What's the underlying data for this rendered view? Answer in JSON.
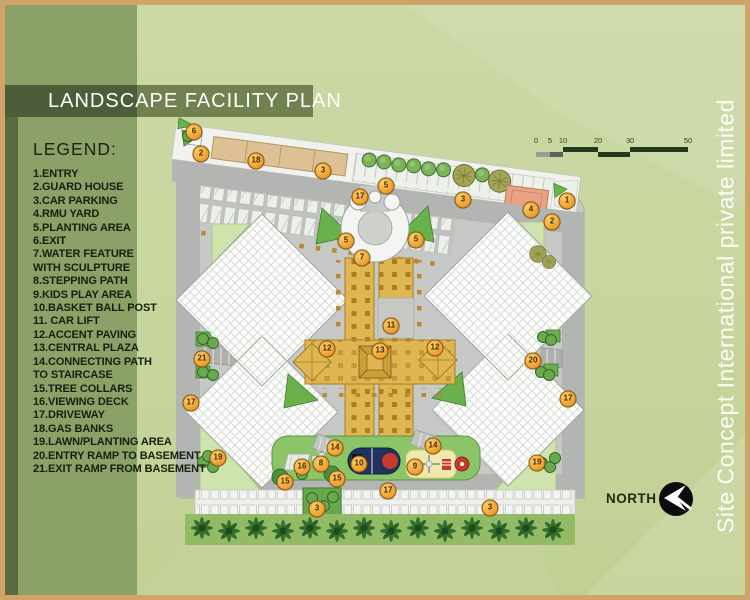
{
  "title": {
    "text": "LANDSCAPE FACILITY PLAN"
  },
  "legend": {
    "heading": "LEGEND:",
    "lines": [
      "1.ENTRY",
      "2.GUARD HOUSE",
      "3.CAR PARKING",
      "4.RMU YARD",
      "5.PLANTING AREA",
      "6.EXIT",
      "7.WATER FEATURE",
      "WITH SCULPTURE",
      "8.STEPPING PATH",
      "9.KIDS PLAY AREA",
      "10.BASKET BALL POST",
      "11. CAR LIFT",
      "12.ACCENT PAVING",
      "13.CENTRAL PLAZA",
      "14.CONNECTING PATH",
      "TO STAIRCASE",
      "15.TREE COLLARS",
      "16.VIEWING DECK",
      "17.DRIVEWAY",
      "18.GAS BANKS",
      "19.LAWN/PLANTING AREA",
      "20.ENTRY RAMP TO BASEMENT",
      "21.EXIT RAMP FROM BASEMENT"
    ]
  },
  "side_text": "Site Concept International private limited",
  "north": {
    "label": "NORTH"
  },
  "scale_bar": {
    "labels": [
      "0",
      "5",
      "10",
      "20",
      "30",
      "50"
    ]
  },
  "markers": [
    {
      "n": "6",
      "x": 189,
      "y": 127
    },
    {
      "n": "2",
      "x": 196,
      "y": 149
    },
    {
      "n": "18",
      "x": 251,
      "y": 156
    },
    {
      "n": "3",
      "x": 318,
      "y": 166
    },
    {
      "n": "5",
      "x": 381,
      "y": 181
    },
    {
      "n": "17",
      "x": 355,
      "y": 192
    },
    {
      "n": "3",
      "x": 458,
      "y": 195
    },
    {
      "n": "1",
      "x": 562,
      "y": 196
    },
    {
      "n": "4",
      "x": 526,
      "y": 205
    },
    {
      "n": "2",
      "x": 547,
      "y": 217
    },
    {
      "n": "5",
      "x": 341,
      "y": 236
    },
    {
      "n": "5",
      "x": 411,
      "y": 235
    },
    {
      "n": "7",
      "x": 357,
      "y": 253
    },
    {
      "n": "11",
      "x": 386,
      "y": 321
    },
    {
      "n": "12",
      "x": 322,
      "y": 344
    },
    {
      "n": "13",
      "x": 375,
      "y": 346
    },
    {
      "n": "12",
      "x": 430,
      "y": 343
    },
    {
      "n": "21",
      "x": 197,
      "y": 354
    },
    {
      "n": "20",
      "x": 528,
      "y": 356
    },
    {
      "n": "17",
      "x": 186,
      "y": 398
    },
    {
      "n": "17",
      "x": 563,
      "y": 394
    },
    {
      "n": "19",
      "x": 213,
      "y": 453
    },
    {
      "n": "14",
      "x": 330,
      "y": 443
    },
    {
      "n": "14",
      "x": 428,
      "y": 441
    },
    {
      "n": "8",
      "x": 316,
      "y": 459
    },
    {
      "n": "16",
      "x": 297,
      "y": 462
    },
    {
      "n": "10",
      "x": 354,
      "y": 459
    },
    {
      "n": "9",
      "x": 410,
      "y": 462
    },
    {
      "n": "15",
      "x": 280,
      "y": 477
    },
    {
      "n": "15",
      "x": 332,
      "y": 474
    },
    {
      "n": "17",
      "x": 383,
      "y": 486
    },
    {
      "n": "3",
      "x": 312,
      "y": 504
    },
    {
      "n": "3",
      "x": 485,
      "y": 503
    },
    {
      "n": "19",
      "x": 532,
      "y": 458
    }
  ],
  "colors": {
    "frame": "#d2a369",
    "background": "#c7d59e",
    "panel_green": "#8ba168",
    "band_dark": "#4d5d39",
    "marker_orange": "#f0a434",
    "accent_gold": "#e0b652",
    "planting_green": "#68b14d",
    "lawn_green": "#93bb66",
    "driveway_gray": "#b3b5b2"
  }
}
